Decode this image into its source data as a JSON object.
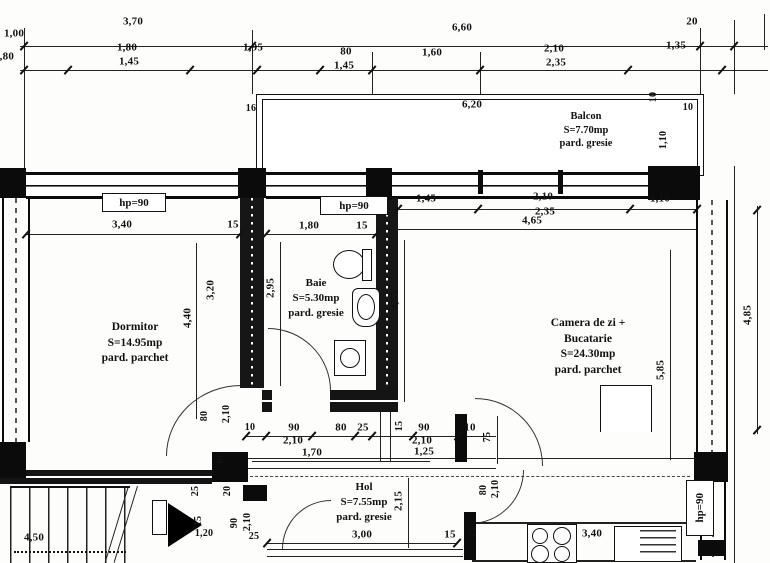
{
  "rooms": {
    "dormitor": {
      "name": "Dormitor",
      "area": "S=14.95mp",
      "floor": "pard. parchet"
    },
    "baie": {
      "name": "Baie",
      "area": "S=5.30mp",
      "floor": "pard. gresie"
    },
    "camera": {
      "name1": "Camera de zi +",
      "name2": "Bucatarie",
      "area": "S=24.30mp",
      "floor": "pard. parchet"
    },
    "hol": {
      "name": "Hol",
      "area": "S=7.55mp",
      "floor": "pard. gresie"
    },
    "balcon": {
      "name": "Balcon",
      "area": "S=7.70mp",
      "floor": "pard. gresie"
    }
  },
  "windows": {
    "parapet": "hp=90"
  },
  "dims": {
    "t1_100": "1,00",
    "t1_370": "3,70",
    "t1_660": "6,60",
    "t1_20": "20",
    "t2_edge": "1,80",
    "t2_180": "1,80",
    "t2_145a": "1,45",
    "t2_195": "1,95",
    "t2_80": "80",
    "t2_145b": "1,45",
    "t2_160": "1,60",
    "t2_210": "2,10",
    "t2_235": "2,35",
    "t2_135": "1,35",
    "bal_16": "16",
    "bal_620": "6,20",
    "bal_10a": "10",
    "bal_10b": "10",
    "bal_110": "1,10",
    "dorm_340": "3,40",
    "dorm_15": "15",
    "dorm_440": "4,40",
    "dorm_320": "3,20",
    "baie_180": "1,80",
    "baie_15": "15",
    "baie_295": "2,95",
    "baie_355": "3,55",
    "cam_145": "1,45",
    "cam_210": "2,10",
    "cam_235": "2,35",
    "cam_465": "4,65",
    "cam_110": "1,10",
    "cam_585": "5,85",
    "cam_485": "4,85",
    "d_80": "80",
    "d_210a": "2,10",
    "d_10a": "10",
    "d_90a": "90",
    "d_210b": "2,10",
    "d_80b": "80",
    "d_25a": "25",
    "d_15a": "15",
    "d_90b": "90",
    "d_210c": "2,10",
    "d_10b": "10",
    "d_75a": "75",
    "d_170": "1,70",
    "d_125": "1,25",
    "d_30": "30",
    "hol_300": "3,00",
    "hol_215": "2,15",
    "hol_15": "15",
    "hol_80": "80",
    "hol_210": "2,10",
    "hol_75": "75",
    "kit_340": "3,40",
    "st_450": "4,50",
    "st_120": "1,20",
    "st_15": "15",
    "st_20": "20",
    "st_25a": "25",
    "st_25b": "25",
    "st_90": "90",
    "st_210": "2,10"
  }
}
